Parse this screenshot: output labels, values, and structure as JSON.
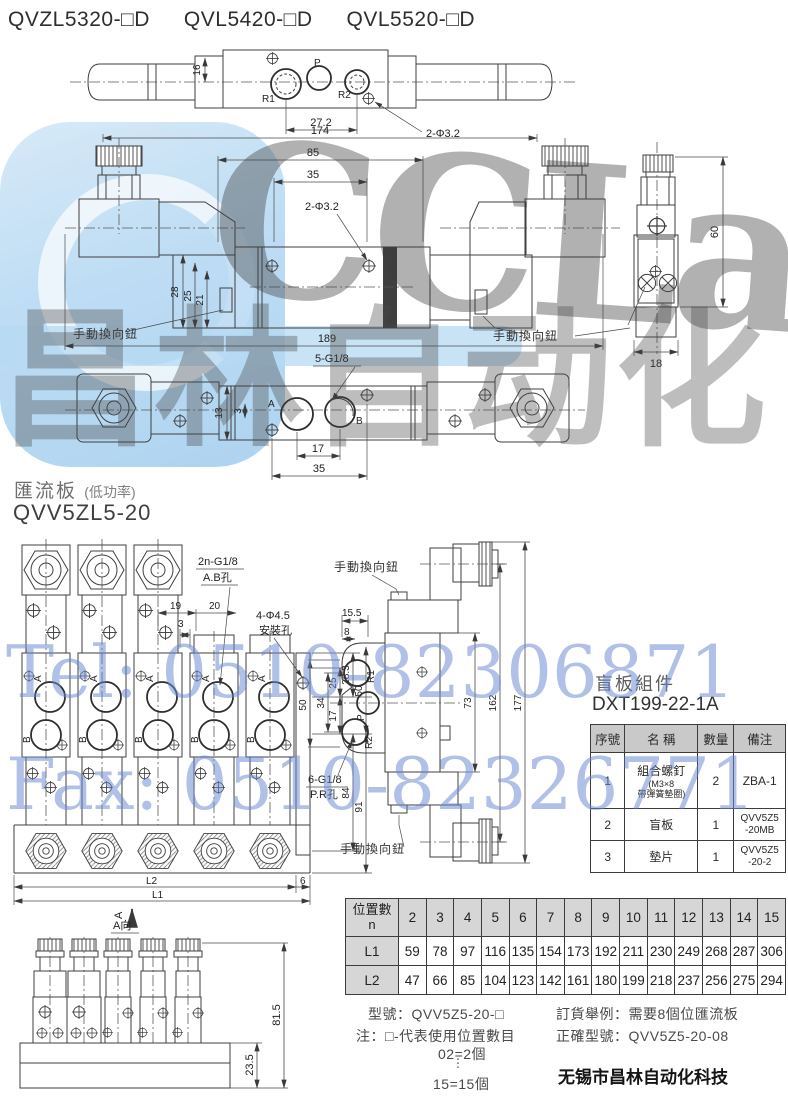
{
  "header": {
    "models": [
      "QVZL5320-□D",
      "QVL5420-□D",
      "QVL5520-□D"
    ]
  },
  "watermark": {
    "brand": "CCLair",
    "brand_cn": "昌林自动化",
    "tel": "Tel: 0510-82306871",
    "fax": "Fax: 0510-82326771",
    "blue": "#b7d9f3",
    "gray": "#7a7a7a"
  },
  "top_view": {
    "p": "P",
    "r1": "R1",
    "r2": "R2",
    "dim_16": "16",
    "dim_272": "27.2",
    "dim_2phi": "2-Φ3.2"
  },
  "front_view": {
    "dim_174": "174",
    "dim_85": "85",
    "dim_35": "35",
    "dim_2phi": "2-Φ3.2",
    "dim_28": "28",
    "dim_25": "25",
    "dim_21": "21",
    "dim_189": "189",
    "knob_left": "手動換向鈕",
    "knob_right": "手動換向鈕"
  },
  "side_view": {
    "dim_60": "60",
    "dim_18": "18"
  },
  "bottom_view": {
    "thread": "5-G1/8",
    "a": "A",
    "b": "B",
    "dim_13": "13",
    "dim_3": "3",
    "dim_17": "17",
    "dim_35": "35"
  },
  "section": {
    "title": "匯流板",
    "subtitle": "(低功率)",
    "model": "QVV5ZL5-20"
  },
  "manifold_front": {
    "thread": "2n-G1/8",
    "thread_sub": "A.B孔",
    "dim_19": "19",
    "dim_20": "20",
    "dim_3": "3",
    "mount": "4-Φ4.5",
    "mount_sub": "安裝孔",
    "dim_25": "25",
    "dim_283": "28.3",
    "dim_17": "17",
    "dim_50": "50",
    "dim_84": "84",
    "dim_91": "91",
    "l2_label": "L2",
    "dim_6": "6",
    "l1_label": "L1",
    "view_arrow": "A",
    "port_a": "A",
    "port_b": "B"
  },
  "manifold_side": {
    "knob_top": "手動換向鈕",
    "knob_bottom": "手動換向鈕",
    "dim_155": "15.5",
    "dim_8": "8",
    "dim_50": "50",
    "dim_34": "34",
    "dim_73": "73",
    "dim_162": "162",
    "dim_177": "177",
    "r1": "R1",
    "p": "P",
    "r2": "R2",
    "thread": "6-G1/8",
    "thread_sub": "P.R孔"
  },
  "blind_plate": {
    "title": "盲板組件",
    "part_no": "DXT199-22-1A",
    "headers": [
      "序號",
      "名 稱",
      "數量",
      "備注"
    ],
    "rows": [
      {
        "no": "1",
        "name": "組合螺釘",
        "name_sub1": "(M3×8",
        "name_sub2": "帶彈簧墊圈)",
        "qty": "2",
        "remark_1": "ZBA-1",
        "remark_2": ""
      },
      {
        "no": "2",
        "name": "盲板",
        "name_sub1": "",
        "name_sub2": "",
        "qty": "1",
        "remark_1": "QVV5Z5",
        "remark_2": "-20MB"
      },
      {
        "no": "3",
        "name": "墊片",
        "name_sub1": "",
        "name_sub2": "",
        "qty": "1",
        "remark_1": "QVV5Z5",
        "remark_2": "-20-2"
      }
    ]
  },
  "a_view": {
    "label": "A向",
    "dim_815": "81.5",
    "dim_235": "23.5"
  },
  "position_table": {
    "col_label_1": "位置數",
    "col_label_2": "n",
    "n": [
      "2",
      "3",
      "4",
      "5",
      "6",
      "7",
      "8",
      "9",
      "10",
      "11",
      "12",
      "13",
      "14",
      "15"
    ],
    "l1_label": "L1",
    "l1": [
      "59",
      "78",
      "97",
      "116",
      "135",
      "154",
      "173",
      "192",
      "211",
      "230",
      "249",
      "268",
      "287",
      "306"
    ],
    "l2_label": "L2",
    "l2": [
      "47",
      "66",
      "85",
      "104",
      "123",
      "142",
      "161",
      "180",
      "199",
      "218",
      "237",
      "256",
      "275",
      "294"
    ]
  },
  "notes": {
    "model_line": "型號：QVV5Z5-20-□",
    "note_line": "注：□-代表使用位置數目",
    "eg_start": "02=2個",
    "dots": "⋮",
    "eg_end": "15=15個",
    "order_line": "訂貨舉例：需要8個位匯流板",
    "correct_line": "正確型號：QVV5Z5-20-08"
  },
  "footer": {
    "company": "无锡市昌林自动化科技"
  }
}
